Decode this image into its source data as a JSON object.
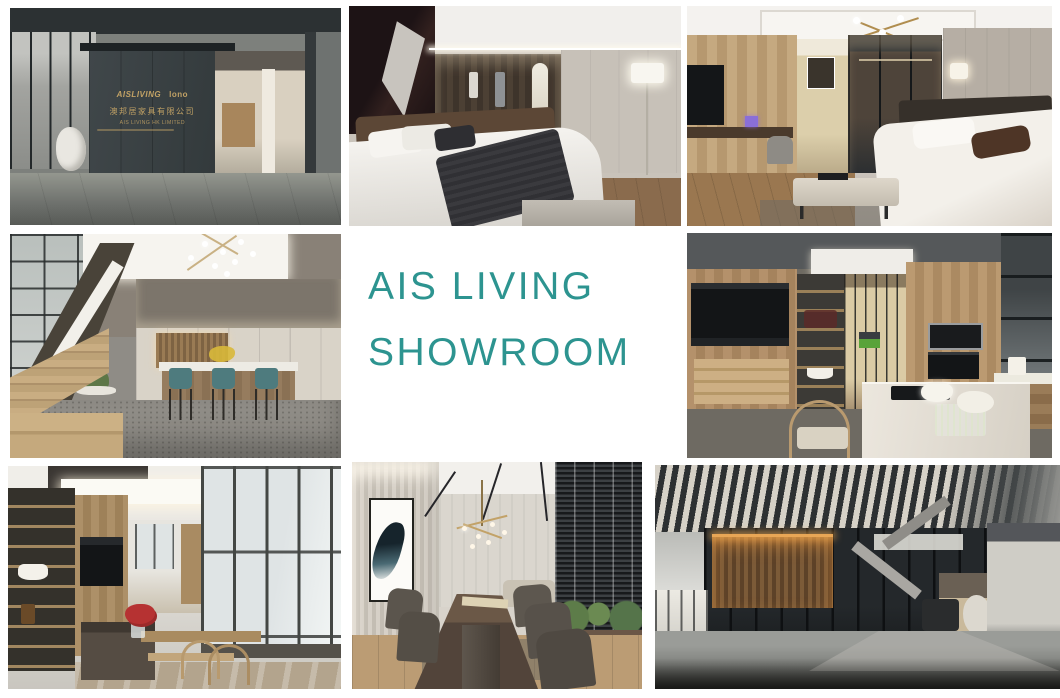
{
  "headline": {
    "line1": "AIS LIVING",
    "line2": "SHOWROOM"
  },
  "storefront_sign": {
    "brand_left": "AISLIVING",
    "brand_right": "lono",
    "company_cn": "澳邦居家具有限公司",
    "company_en": "AIS LIVING HK LIMITED"
  },
  "colors": {
    "headline_teal": "#2D9490",
    "sign_gold": "#C2A265",
    "page_bg": "#FFFFFF",
    "stool_teal": "#4E7B7E"
  }
}
